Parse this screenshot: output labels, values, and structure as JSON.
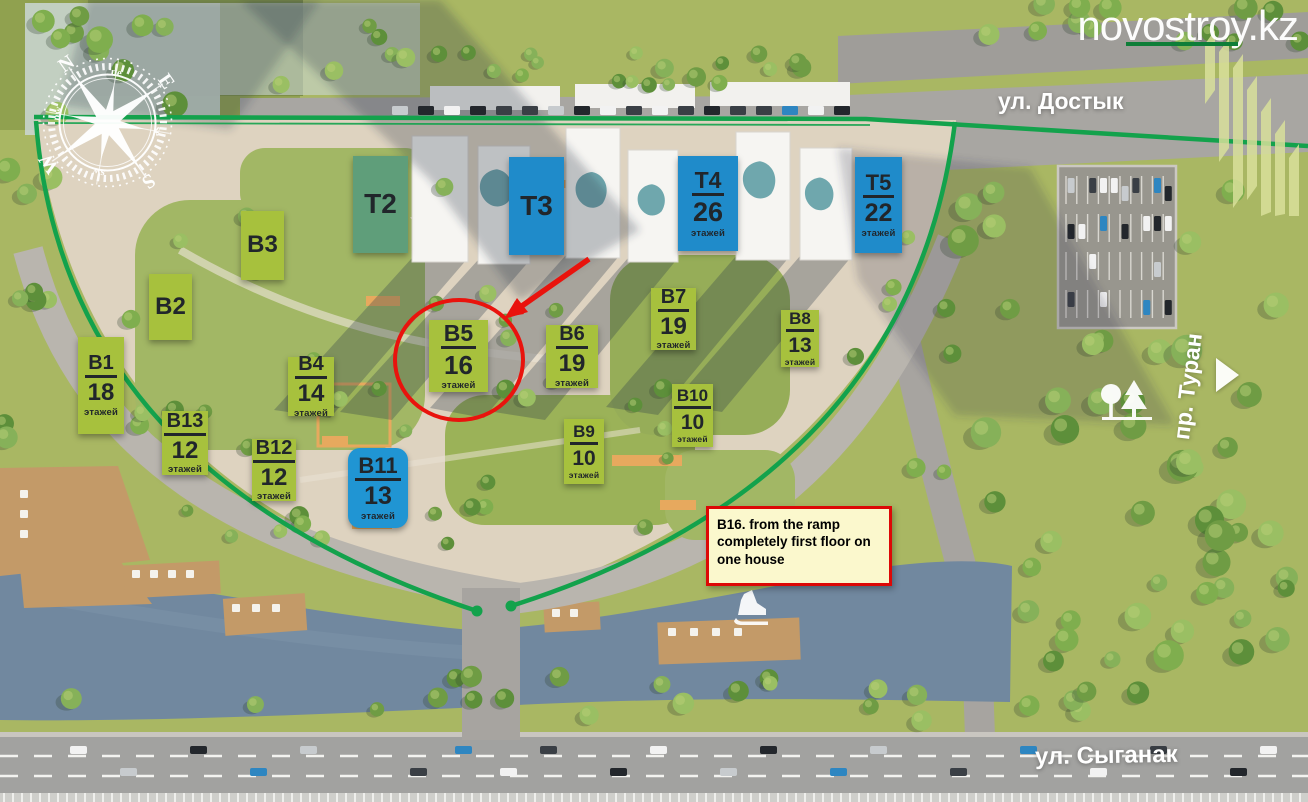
{
  "watermark": {
    "text": "novostroy.kz"
  },
  "streets": {
    "dostyk": "ул. Достык",
    "turan": "пр. Туран",
    "syganak": "ул. Сыганак"
  },
  "annotation_note": {
    "text": "B16. from the ramp completely first floor on one house"
  },
  "floors_word": "этажей",
  "compass": {
    "n": "N",
    "e": "E",
    "s": "S",
    "w": "W",
    "ne": "ne",
    "se": "se",
    "sw": "sw",
    "nw": "nw"
  },
  "colors": {
    "label_green": "#a7c13d",
    "label_blue": "#1f8bca",
    "label_teal": "#5f9e7a",
    "label_blue_round": "#2095d3",
    "highlight_red": "#e9130d",
    "note_bg": "#fbf8cd",
    "note_border": "#dd0806",
    "boundary_green": "#13a24c"
  },
  "buildings": [
    {
      "id": "b1",
      "label": "B1",
      "floors": "18",
      "style": "green"
    },
    {
      "id": "b2",
      "label": "B2",
      "floors": null,
      "style": "green"
    },
    {
      "id": "b3",
      "label": "B3",
      "floors": null,
      "style": "green"
    },
    {
      "id": "b4",
      "label": "B4",
      "floors": "14",
      "style": "green"
    },
    {
      "id": "b5",
      "label": "B5",
      "floors": "16",
      "style": "green",
      "highlighted": true
    },
    {
      "id": "b6",
      "label": "B6",
      "floors": "19",
      "style": "green"
    },
    {
      "id": "b7",
      "label": "B7",
      "floors": "19",
      "style": "green"
    },
    {
      "id": "b8",
      "label": "B8",
      "floors": "13",
      "style": "green"
    },
    {
      "id": "b9",
      "label": "B9",
      "floors": "10",
      "style": "green"
    },
    {
      "id": "b10",
      "label": "B10",
      "floors": "10",
      "style": "green"
    },
    {
      "id": "b11",
      "label": "B11",
      "floors": "13",
      "style": "blue-round"
    },
    {
      "id": "b12",
      "label": "B12",
      "floors": "12",
      "style": "green"
    },
    {
      "id": "b13",
      "label": "B13",
      "floors": "12",
      "style": "green"
    },
    {
      "id": "t2",
      "label": "T2",
      "floors": null,
      "style": "teal"
    },
    {
      "id": "t3",
      "label": "T3",
      "floors": null,
      "style": "blue"
    },
    {
      "id": "t4",
      "label": "T4",
      "floors": "26",
      "style": "blue"
    },
    {
      "id": "t5",
      "label": "T5",
      "floors": "22",
      "style": "blue"
    }
  ]
}
